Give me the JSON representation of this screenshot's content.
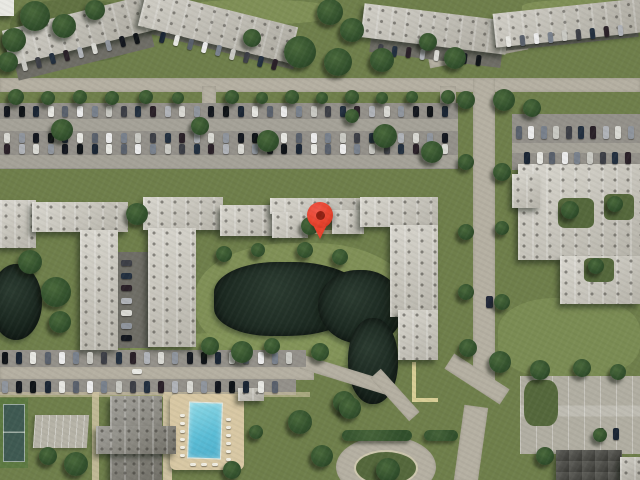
{
  "map": {
    "type": "satellite-imagery",
    "description": "aerial view of apartment complex with pond, parking lots, pool and tennis court",
    "marker": {
      "shape": "map-pin",
      "color": "#e8432d",
      "inner_dot_color": "#8f2113",
      "x": 320,
      "y": 215
    }
  },
  "palette": {
    "grass": "#6f7f4b",
    "grass_light": "#84955a",
    "grass_dark": "#55683c",
    "tree": "#32502c",
    "water": "#17231c",
    "road": "#b5b0a2",
    "asphalt": "#94918a",
    "asphalt_light": "#a5a298",
    "asphalt_dark": "#6f6e66",
    "concrete": "#b1aea2",
    "roof": "#c0bdb2",
    "roof_light": "#cbc8bd",
    "roof_dark": "#7e7c73",
    "deck": "#d8c8a4",
    "pool": "#5bbdd6",
    "court_green": "#5d7a42",
    "court_surface": "#3f5a52",
    "path": "#cfc3a2",
    "pin": "#e8432d",
    "pin_dark": "#8f2113"
  },
  "scene": {
    "car_colors": [
      "#14181f",
      "#e7e7e2",
      "#79818c",
      "#23303f",
      "#d9d9d3",
      "#101418",
      "#5a616c",
      "#c9c9c3",
      "#2a2128",
      "#8f959d",
      "#1b2634",
      "#ececec",
      "#3d3f46",
      "#b0b3b8"
    ],
    "trees": [
      [
        35,
        16,
        15
      ],
      [
        64,
        26,
        12
      ],
      [
        14,
        40,
        12
      ],
      [
        8,
        62,
        10
      ],
      [
        95,
        10,
        10
      ],
      [
        330,
        12,
        13
      ],
      [
        352,
        30,
        12
      ],
      [
        300,
        52,
        16
      ],
      [
        338,
        62,
        14
      ],
      [
        382,
        60,
        12
      ],
      [
        252,
        38,
        9
      ],
      [
        455,
        58,
        11
      ],
      [
        428,
        42,
        9
      ],
      [
        16,
        97,
        8
      ],
      [
        48,
        98,
        7
      ],
      [
        80,
        97,
        7
      ],
      [
        112,
        98,
        7
      ],
      [
        146,
        97,
        7
      ],
      [
        178,
        98,
        6
      ],
      [
        232,
        97,
        7
      ],
      [
        262,
        98,
        6
      ],
      [
        292,
        97,
        7
      ],
      [
        322,
        98,
        6
      ],
      [
        352,
        97,
        7
      ],
      [
        382,
        98,
        6
      ],
      [
        412,
        97,
        6
      ],
      [
        448,
        97,
        7
      ],
      [
        62,
        130,
        11
      ],
      [
        200,
        126,
        9
      ],
      [
        268,
        141,
        11
      ],
      [
        385,
        136,
        12
      ],
      [
        432,
        152,
        11
      ],
      [
        352,
        116,
        7
      ],
      [
        466,
        100,
        9
      ],
      [
        504,
        100,
        11
      ],
      [
        532,
        108,
        9
      ],
      [
        466,
        162,
        8
      ],
      [
        502,
        172,
        9
      ],
      [
        466,
        232,
        8
      ],
      [
        502,
        228,
        7
      ],
      [
        466,
        292,
        8
      ],
      [
        502,
        302,
        8
      ],
      [
        468,
        348,
        9
      ],
      [
        500,
        362,
        11
      ],
      [
        540,
        370,
        10
      ],
      [
        582,
        368,
        9
      ],
      [
        618,
        372,
        8
      ],
      [
        137,
        214,
        11
      ],
      [
        30,
        262,
        12
      ],
      [
        56,
        292,
        15
      ],
      [
        60,
        322,
        11
      ],
      [
        224,
        254,
        8
      ],
      [
        258,
        250,
        7
      ],
      [
        305,
        250,
        8
      ],
      [
        340,
        257,
        8
      ],
      [
        310,
        226,
        9
      ],
      [
        210,
        346,
        9
      ],
      [
        242,
        352,
        11
      ],
      [
        272,
        346,
        8
      ],
      [
        320,
        352,
        9
      ],
      [
        344,
        402,
        11
      ],
      [
        300,
        422,
        12
      ],
      [
        322,
        456,
        11
      ],
      [
        76,
        464,
        12
      ],
      [
        48,
        456,
        9
      ],
      [
        256,
        432,
        7
      ],
      [
        232,
        470,
        9
      ],
      [
        350,
        408,
        11
      ],
      [
        388,
        470,
        12
      ],
      [
        545,
        456,
        9
      ],
      [
        600,
        435,
        7
      ],
      [
        570,
        210,
        9
      ],
      [
        615,
        204,
        8
      ],
      [
        596,
        266,
        8
      ]
    ],
    "car_rows": [
      {
        "x": 4,
        "y": 106,
        "n": 31,
        "dx": 14.6,
        "w": 6,
        "h": 11
      },
      {
        "x": 4,
        "y": 133,
        "n": 31,
        "dx": 14.6,
        "w": 6,
        "h": 10,
        "seed": 3
      },
      {
        "x": 4,
        "y": 144,
        "n": 31,
        "dx": 14.6,
        "w": 6,
        "h": 10,
        "seed": 6
      },
      {
        "x": 2,
        "y": 352,
        "n": 21,
        "dx": 14.2,
        "w": 6,
        "h": 12,
        "seed": 2
      },
      {
        "x": 2,
        "y": 381,
        "n": 20,
        "dx": 14.2,
        "w": 6,
        "h": 12,
        "seed": 5
      },
      {
        "x": 516,
        "y": 126,
        "n": 10,
        "dx": 12.4,
        "w": 6,
        "h": 13,
        "seed": 1
      },
      {
        "x": 524,
        "y": 152,
        "n": 9,
        "dx": 12.6,
        "w": 6,
        "h": 12,
        "seed": 4
      },
      {
        "x": 22,
        "y": 60,
        "n": 9,
        "dx": 14,
        "slope": -0.24,
        "rot": -14,
        "w": 5,
        "h": 11
      },
      {
        "x": 160,
        "y": 32,
        "n": 9,
        "dx": 14,
        "slope": 0.24,
        "rot": 14,
        "w": 5,
        "h": 11,
        "seed": 2
      },
      {
        "x": 378,
        "y": 44,
        "n": 8,
        "dx": 14,
        "slope": 0.11,
        "rot": 7,
        "w": 5,
        "h": 11,
        "seed": 3
      },
      {
        "x": 506,
        "y": 36,
        "n": 9,
        "dx": 14,
        "slope": -0.1,
        "rot": -6,
        "w": 5,
        "h": 11,
        "seed": 5
      },
      {
        "x": 121,
        "y": 260,
        "n": 7,
        "dy": 12.5,
        "w": 11,
        "h": 6,
        "seed": 1
      },
      {
        "x": 598,
        "y": 428,
        "n": 2,
        "dx": 15,
        "w": 6,
        "h": 12,
        "seed": 7
      },
      {
        "x": 132,
        "y": 369,
        "n": 1,
        "w": 10,
        "h": 5,
        "color": "#e9e9e4"
      },
      {
        "x": 486,
        "y": 296,
        "n": 1,
        "w": 7,
        "h": 12,
        "color": "#23293a"
      },
      {
        "x": 180,
        "y": 414,
        "n": 6,
        "dy": 8,
        "w": 5,
        "h": 3,
        "color": "#f2efe4"
      },
      {
        "x": 226,
        "y": 418,
        "n": 6,
        "dy": 8,
        "w": 5,
        "h": 3,
        "color": "#f2efe4"
      },
      {
        "x": 190,
        "y": 463,
        "n": 3,
        "dx": 11,
        "w": 6,
        "h": 3,
        "color": "#f2efe4"
      }
    ]
  }
}
